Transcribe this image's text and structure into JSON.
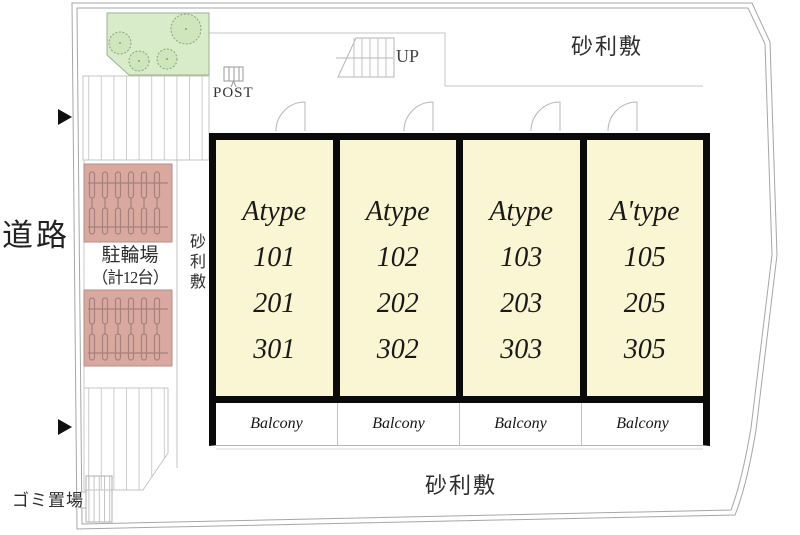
{
  "site": {
    "road_label": "道路",
    "gravel_labels": {
      "top": "砂利敷",
      "side": "砂利敷",
      "bottom": "砂利敷"
    },
    "bicycle_parking": {
      "title": "駐輪場",
      "capacity": "（計12台）"
    },
    "garbage_label": "ゴミ置場",
    "post_label": "POST",
    "stairs_up_label": "UP"
  },
  "building": {
    "units": [
      {
        "type": "Atype",
        "rooms": [
          "101",
          "201",
          "301"
        ]
      },
      {
        "type": "Atype",
        "rooms": [
          "102",
          "202",
          "302"
        ]
      },
      {
        "type": "Atype",
        "rooms": [
          "103",
          "203",
          "303"
        ]
      },
      {
        "type": "A'type",
        "rooms": [
          "105",
          "205",
          "305"
        ]
      }
    ],
    "balcony_label": "Balcony"
  },
  "colors": {
    "room_fill": "#faf6d3",
    "planting_fill": "#d9ecca",
    "tree_fill": "#cfe6bd",
    "bike_area_fill": "#d9a9a0",
    "wall_black": "#0a0a0a",
    "line_gray": "#a6a6a6"
  }
}
